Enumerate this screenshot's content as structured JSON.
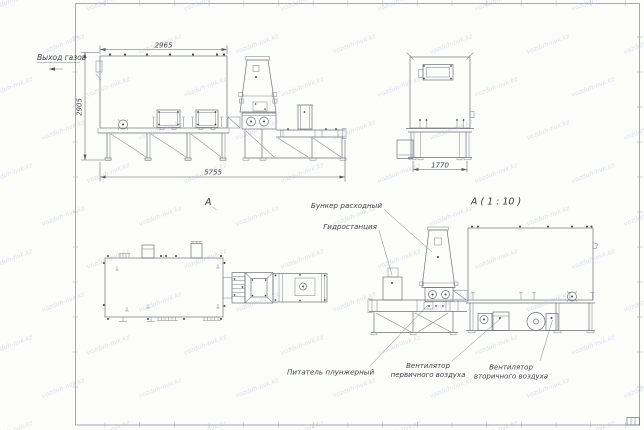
{
  "drawing": {
    "watermark_text": "vozduh-nvk.kz",
    "labels": {
      "gas_outlet": "Выход газов",
      "view_arrow": "А",
      "detail_title": "А ( 1 : 10 )",
      "hopper": "Бункер расходный",
      "hydro": "Гидростанция",
      "feeder": "Питатель плунжерный",
      "fan_primary_line1": "Вентилятор",
      "fan_primary_line2": "первичного воздуха",
      "fan_secondary_line1": "Вентилятор",
      "fan_secondary_line2": "вторичного воздуха"
    },
    "dimensions": {
      "side_top_width": "2965",
      "side_height": "2905",
      "side_total_length": "5755",
      "front_width": "1770"
    },
    "colors": {
      "line": "#6e737a",
      "text": "#3a3f45",
      "watermark": "#b7c2d4",
      "frame": "#9ba1a9",
      "background": "#fcfcfb"
    }
  }
}
